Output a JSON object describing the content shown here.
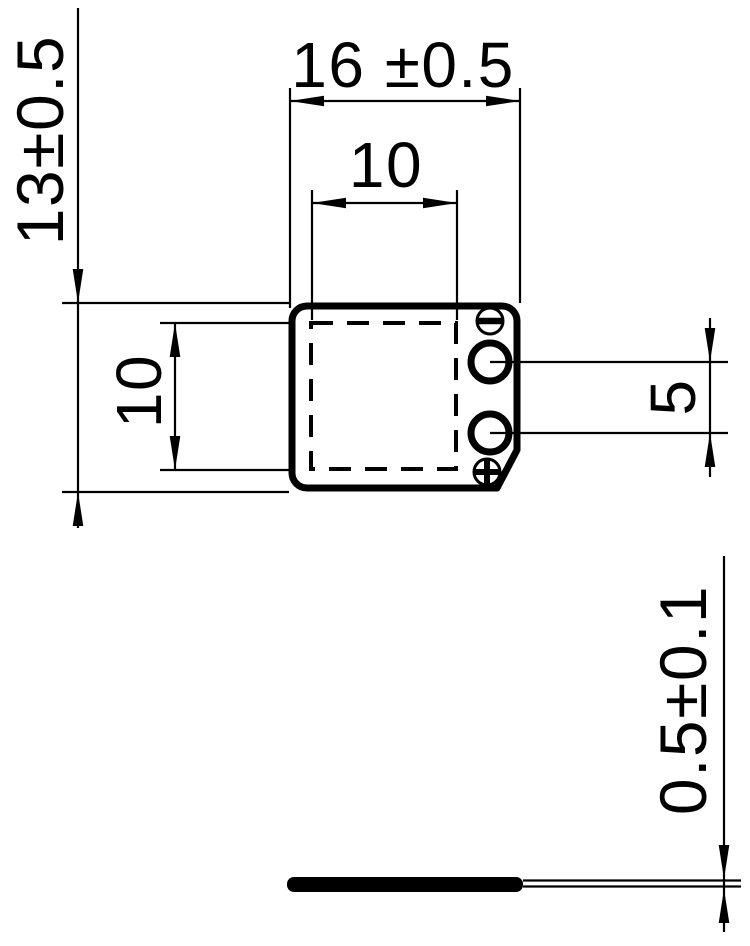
{
  "palette": {
    "ink": "#000000",
    "paper": "#ffffff"
  },
  "dimensions": {
    "overall_width": "16 ±0.5",
    "inner_width": "10",
    "overall_height": "13±0.5",
    "inner_height": "10",
    "terminal_spacing": "5",
    "plate_thickness": "0.5±0.1"
  },
  "polarity_markers": {
    "negative": "−",
    "positive": "+"
  }
}
